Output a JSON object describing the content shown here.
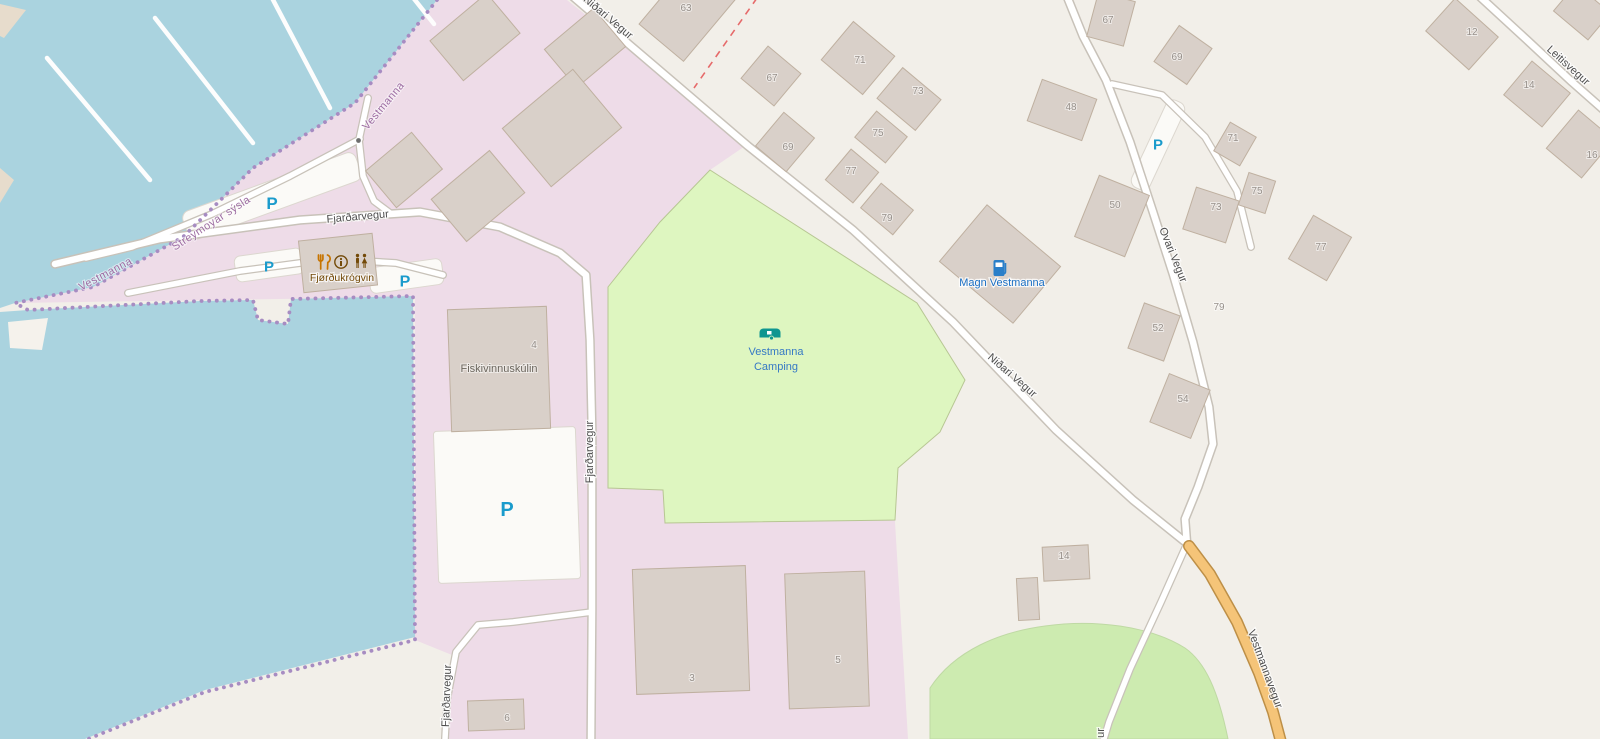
{
  "map": {
    "place": "Vestmanna",
    "colors": {
      "water": "#aad3df",
      "land": "#f2efe9",
      "industrial_area": "#eedce8",
      "camp_site": "#def6c0",
      "grass": "#cdebb0",
      "building": "#d9d0c9",
      "building_border": "#bfb0a0",
      "road": "#ffffff",
      "road_casing": "#c8c2b9",
      "secondary_road": "#f5c478",
      "secondary_road_casing": "#bd8f47",
      "boundary_dots": "#a78cc2",
      "boundary_label": "#9d6da2",
      "red_boundary": "#e66a6a",
      "road_label": "#4e4e4e",
      "house_number": "#97908a",
      "parking_blue": "#1a9bcc",
      "poi_brown": "#734a08",
      "poi_blue": "#1a6fc4",
      "camping_icon_teal": "#0f9690",
      "camping_label_blue": "#3579c4"
    },
    "road_labels": [
      {
        "t": "Niðari Vegur",
        "x": 606,
        "y": 20,
        "r": 40
      },
      {
        "t": "Niðari Vegur",
        "x": 1010,
        "y": 378,
        "r": 41
      },
      {
        "t": "Fjarðarvegur",
        "x": 358,
        "y": 220,
        "r": -5
      },
      {
        "t": "Fjarðarvegur",
        "x": 593,
        "y": 452,
        "r": -90
      },
      {
        "t": "Fjarðarvegur",
        "x": 450,
        "y": 696,
        "r": -88
      },
      {
        "t": "Ovari Vegur",
        "x": 1170,
        "y": 256,
        "r": 68
      },
      {
        "t": "Leitisvegur",
        "x": 1566,
        "y": 68,
        "r": 42
      },
      {
        "t": "Vestmannavegur",
        "x": 1262,
        "y": 670,
        "r": 70,
        "anchor": "start"
      },
      {
        "t": "ur",
        "x": 1104,
        "y": 733,
        "r": -90
      }
    ],
    "boundary_labels": [
      {
        "t": "Vestmanna",
        "x": 107,
        "y": 277,
        "r": -28
      },
      {
        "t": "Streymoyar sýsla",
        "x": 213,
        "y": 226,
        "r": -33
      },
      {
        "t": "Vestmanna",
        "x": 386,
        "y": 108,
        "r": -50
      }
    ],
    "house_numbers": [
      {
        "t": "63",
        "x": 686,
        "y": 11
      },
      {
        "t": "67",
        "x": 772,
        "y": 81
      },
      {
        "t": "71",
        "x": 860,
        "y": 63
      },
      {
        "t": "73",
        "x": 918,
        "y": 94
      },
      {
        "t": "75",
        "x": 878,
        "y": 136
      },
      {
        "t": "69",
        "x": 788,
        "y": 150
      },
      {
        "t": "77",
        "x": 851,
        "y": 174
      },
      {
        "t": "79",
        "x": 887,
        "y": 221
      },
      {
        "t": "48",
        "x": 1071,
        "y": 110
      },
      {
        "t": "67",
        "x": 1108,
        "y": 23
      },
      {
        "t": "69",
        "x": 1177,
        "y": 60
      },
      {
        "t": "71",
        "x": 1233,
        "y": 141
      },
      {
        "t": "73",
        "x": 1216,
        "y": 210
      },
      {
        "t": "75",
        "x": 1257,
        "y": 194
      },
      {
        "t": "77",
        "x": 1321,
        "y": 250
      },
      {
        "t": "50",
        "x": 1115,
        "y": 208
      },
      {
        "t": "52",
        "x": 1158,
        "y": 331
      },
      {
        "t": "54",
        "x": 1183,
        "y": 402
      },
      {
        "t": "79",
        "x": 1219,
        "y": 310
      },
      {
        "t": "12",
        "x": 1472,
        "y": 35
      },
      {
        "t": "14",
        "x": 1529,
        "y": 88
      },
      {
        "t": "16",
        "x": 1592,
        "y": 158
      },
      {
        "t": "4",
        "x": 534,
        "y": 348
      },
      {
        "t": "3",
        "x": 692,
        "y": 681
      },
      {
        "t": "5",
        "x": 838,
        "y": 663
      },
      {
        "t": "6",
        "x": 507,
        "y": 721
      },
      {
        "t": "14",
        "x": 1064,
        "y": 559
      }
    ],
    "parking": {
      "symbol": "P",
      "positions": [
        {
          "x": 272,
          "y": 203,
          "s": 17
        },
        {
          "x": 269,
          "y": 266,
          "s": 15
        },
        {
          "x": 405,
          "y": 281,
          "s": 16
        },
        {
          "x": 507,
          "y": 509,
          "s": 20
        },
        {
          "x": 1158,
          "y": 144,
          "s": 15
        }
      ]
    },
    "pois": {
      "fjordukrogvin": {
        "label": "Fjørðukrógvin",
        "icons": [
          "restaurant-icon",
          "information-icon",
          "toilets-icon"
        ]
      },
      "magn": {
        "label": "Magn Vestmanna",
        "icon": "fuel-icon"
      },
      "camping": {
        "label_line1": "Vestmanna",
        "label_line2": "Camping",
        "icon": "caravan-icon"
      }
    },
    "building_names": {
      "fiskivinnuskulin": "Fiskivinnuskúlin"
    }
  }
}
